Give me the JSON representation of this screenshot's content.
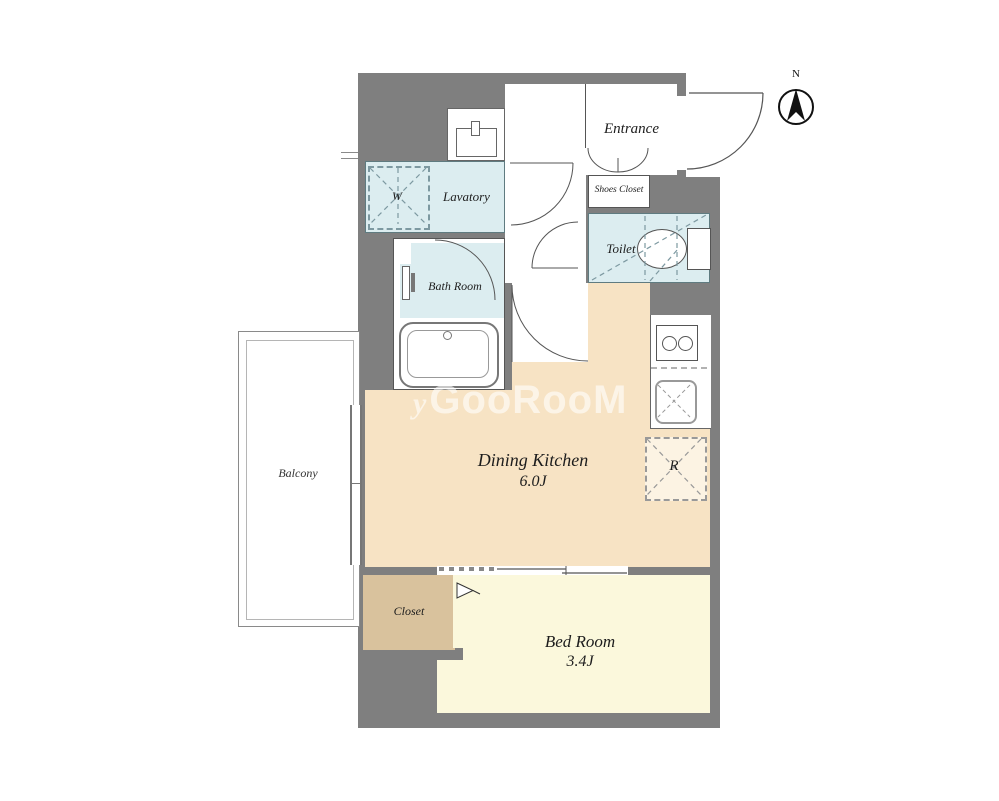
{
  "plan": {
    "compass": {
      "north_label": "N"
    },
    "watermark": {
      "prefix": "y",
      "text": "GooRooM"
    },
    "rooms": {
      "entrance": {
        "label": "Entrance"
      },
      "shoes_closet": {
        "label": "Shoes Closet"
      },
      "toilet": {
        "label": "Toilet"
      },
      "lavatory": {
        "label": "Lavatory"
      },
      "washing_machine": {
        "label": "W"
      },
      "bath": {
        "label": "Bath Room"
      },
      "dining_kitchen": {
        "label": "Dining Kitchen",
        "size": "6.0J"
      },
      "refrigerator": {
        "label": "R"
      },
      "bedroom": {
        "label": "Bed Room",
        "size": "3.4J"
      },
      "closet": {
        "label": "Closet"
      },
      "balcony": {
        "label": "Balcony"
      }
    },
    "colors": {
      "wall": "#7f7f7f",
      "water_rooms": "#dcedf0",
      "dining_kitchen": "#f7e3c4",
      "bedroom": "#fbf8dc",
      "closet": "#d9c29d"
    }
  }
}
